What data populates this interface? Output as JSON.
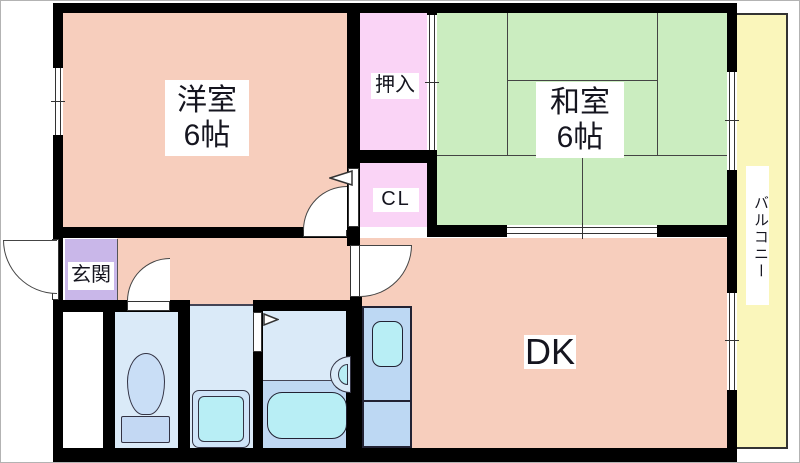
{
  "rooms": {
    "western": {
      "label": "洋室",
      "size": "6帖"
    },
    "japanese": {
      "label": "和室",
      "size": "6帖"
    },
    "oshiire": {
      "label": "押入"
    },
    "closet": {
      "label": "CL"
    },
    "entrance": {
      "label": "玄関"
    },
    "dining_kitchen": {
      "label": "DK"
    },
    "balcony": {
      "label": "バルコニー"
    }
  },
  "fixtures": {
    "toilet": "toilet",
    "bathtub": "bathtub",
    "washing_machine": "washing-machine",
    "wash_basin": "wash-basin",
    "kitchen_sink": "kitchen-sink"
  },
  "colors": {
    "wall": "#000000",
    "line": "#444444",
    "floor_salmon": "#F7CEBD",
    "tatami_green": "#CBEDC0",
    "closet_pink": "#FAD4F6",
    "entrance_purple": "#C9B7E9",
    "balcony_yellow": "#FAF6BB",
    "water_light": "#DAEAF8",
    "water_mid": "#BFD8F2",
    "kitchen_blue": "#BDD8F3",
    "fixture_cyan": "#B8EEF5",
    "bowl_blue": "#C9DEF6",
    "tank_blue": "#C3D8F3",
    "washer_frame": "#CFE4F8"
  }
}
